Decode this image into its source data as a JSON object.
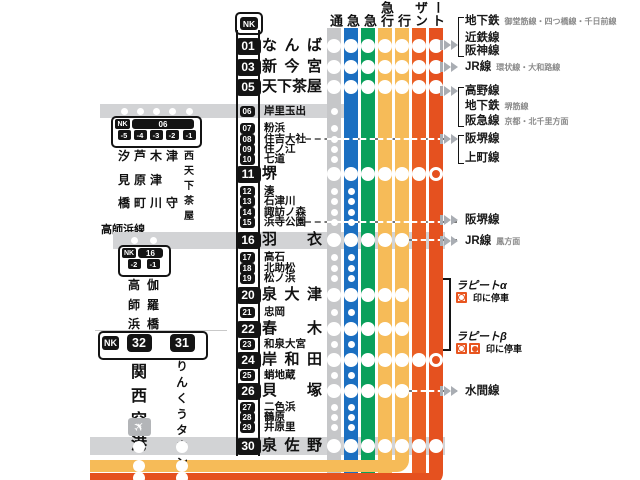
{
  "map": {
    "operator_prefix": "NK",
    "columns": [
      {
        "name": "local",
        "header": "通",
        "color": "#c6c7c9",
        "bottom": 480
      },
      {
        "name": "semi-express",
        "header": "急",
        "color": "#1b6fc1",
        "bottom": 480
      },
      {
        "name": "sub-express",
        "header": "急",
        "color": "#0aa05c",
        "bottom": 480
      },
      {
        "name": "express",
        "header": "急行",
        "color": "#f6bb58",
        "bottom": 480
      },
      {
        "name": "airport-express",
        "header": "行",
        "color": "#f6bb58",
        "bottom": 460
      },
      {
        "name": "southern",
        "header": "ザン",
        "color": "#ea5f24",
        "bottom": 480
      },
      {
        "name": "rapit",
        "header": "ート",
        "color": "#e5511f",
        "bottom": 473
      }
    ],
    "stations": [
      {
        "num": "01",
        "name": "なんば",
        "major": true,
        "y": 46,
        "marks": [
          "stop",
          "stop",
          "stop",
          "stop",
          "stop",
          "stop",
          "stop"
        ]
      },
      {
        "num": "03",
        "name": "新今宮",
        "major": true,
        "y": 67,
        "marks": [
          "stop",
          "stop",
          "stop",
          "stop",
          "stop",
          "stop",
          "stop"
        ]
      },
      {
        "num": "05",
        "name": "天下茶屋",
        "major": true,
        "y": 87,
        "marks": [
          "stop",
          "stop",
          "stop",
          "stop",
          "stop",
          "stop",
          "stop"
        ]
      },
      {
        "num": "06",
        "name": "岸里玉出",
        "major": false,
        "y": 111,
        "band": {
          "x1": 100,
          "x2": 345,
          "h": 14
        },
        "marks": [
          "dot",
          "",
          "",
          "",
          "",
          "",
          ""
        ]
      },
      {
        "num": "07",
        "name": "粉浜",
        "major": false,
        "y": 128,
        "marks": [
          "dot",
          "",
          "",
          "",
          "",
          "",
          ""
        ]
      },
      {
        "num": "08",
        "name": "住吉大社",
        "major": false,
        "y": 139,
        "dash": {
          "from": 305,
          "c1": 0,
          "c2": 6
        },
        "marks": [
          "dot",
          "",
          "",
          "",
          "",
          "",
          ""
        ]
      },
      {
        "num": "09",
        "name": "住ノ江",
        "major": false,
        "y": 149,
        "marks": [
          "dot",
          "",
          "",
          "",
          "",
          "",
          ""
        ]
      },
      {
        "num": "10",
        "name": "七道",
        "major": false,
        "y": 159,
        "marks": [
          "dot",
          "",
          "",
          "",
          "",
          "",
          ""
        ]
      },
      {
        "num": "11",
        "name": "堺",
        "major": true,
        "y": 174,
        "marks": [
          "stop",
          "stop",
          "stop",
          "stop",
          "stop",
          "stop",
          "ring"
        ]
      },
      {
        "num": "12",
        "name": "湊",
        "major": false,
        "y": 191,
        "marks": [
          "dot",
          "dot",
          "",
          "",
          "",
          "",
          ""
        ]
      },
      {
        "num": "13",
        "name": "石津川",
        "major": false,
        "y": 201,
        "marks": [
          "dot",
          "dot",
          "",
          "",
          "",
          "",
          ""
        ]
      },
      {
        "num": "14",
        "name": "諏訪ノ森",
        "major": false,
        "y": 212,
        "marks": [
          "dot",
          "dot",
          "",
          "",
          "",
          "",
          ""
        ]
      },
      {
        "num": "15",
        "name": "浜寺公園",
        "major": false,
        "y": 222,
        "dash": {
          "from": 305,
          "c1": 0,
          "c2": 6
        },
        "marks": [
          "dot",
          "dot",
          "",
          "",
          "",
          "",
          ""
        ]
      },
      {
        "num": "16",
        "name": "羽衣",
        "major": true,
        "y": 240,
        "band": {
          "x1": 113,
          "x2": 445,
          "h": 17
        },
        "dash": {
          "from": 408,
          "c1": 5,
          "c2": 6
        },
        "marks": [
          "stop",
          "stop",
          "stop",
          "stop",
          "stop",
          "",
          ""
        ]
      },
      {
        "num": "17",
        "name": "高石",
        "major": false,
        "y": 257,
        "marks": [
          "dot",
          "dot",
          "",
          "",
          "",
          "",
          ""
        ]
      },
      {
        "num": "18",
        "name": "北助松",
        "major": false,
        "y": 268,
        "marks": [
          "dot",
          "dot",
          "",
          "",
          "",
          "",
          ""
        ]
      },
      {
        "num": "19",
        "name": "松ノ浜",
        "major": false,
        "y": 278,
        "marks": [
          "dot",
          "dot",
          "",
          "",
          "",
          "",
          ""
        ]
      },
      {
        "num": "20",
        "name": "泉大津",
        "major": true,
        "y": 295,
        "marks": [
          "stop",
          "stop",
          "stop",
          "stop",
          "stop",
          "",
          ""
        ]
      },
      {
        "num": "21",
        "name": "忠岡",
        "major": false,
        "y": 312,
        "marks": [
          "dot",
          "dot",
          "",
          "",
          "",
          "",
          ""
        ]
      },
      {
        "num": "22",
        "name": "春木",
        "major": true,
        "y": 329,
        "marks": [
          "stop",
          "stop",
          "stop",
          "stop",
          "stop",
          "",
          ""
        ]
      },
      {
        "num": "23",
        "name": "和泉大宮",
        "major": false,
        "y": 344,
        "marks": [
          "dot",
          "dot",
          "",
          "",
          "",
          "",
          ""
        ]
      },
      {
        "num": "24",
        "name": "岸和田",
        "major": true,
        "y": 360,
        "marks": [
          "stop",
          "stop",
          "stop",
          "stop",
          "stop",
          "stop",
          "ring"
        ]
      },
      {
        "num": "25",
        "name": "蛸地蔵",
        "major": false,
        "y": 375,
        "marks": [
          "dot",
          "dot",
          "",
          "",
          "",
          "",
          ""
        ]
      },
      {
        "num": "26",
        "name": "貝塚",
        "major": true,
        "y": 391,
        "dash": {
          "from": 408,
          "c1": 5,
          "c2": 6
        },
        "marks": [
          "stop",
          "stop",
          "stop",
          "stop",
          "stop",
          "",
          ""
        ]
      },
      {
        "num": "27",
        "name": "二色浜",
        "major": false,
        "y": 407,
        "marks": [
          "dot",
          "dot",
          "",
          "",
          "",
          "",
          ""
        ]
      },
      {
        "num": "28",
        "name": "鶴原",
        "major": false,
        "y": 417,
        "marks": [
          "dot",
          "dot",
          "",
          "",
          "",
          "",
          ""
        ]
      },
      {
        "num": "29",
        "name": "井原里",
        "major": false,
        "y": 427,
        "marks": [
          "dot",
          "dot",
          "",
          "",
          "",
          "",
          ""
        ]
      },
      {
        "num": "30",
        "name": "泉佐野",
        "major": true,
        "y": 446,
        "band": {
          "x1": 90,
          "x2": 445,
          "h": 18
        },
        "marks": [
          "stop",
          "stop",
          "stop",
          "stop",
          "stop",
          "stop",
          "stop"
        ]
      }
    ]
  },
  "branches": {
    "shiomibashi": {
      "badge_number": "06",
      "sub_numbers": [
        "-5",
        "-4",
        "-3",
        "-2",
        "-1"
      ],
      "stations": [
        "汐見橋",
        "芦原町",
        "木津川",
        "津守",
        "西天下茶屋"
      ]
    },
    "takashinohama": {
      "line_label": "高師浜線",
      "badge_number": "16",
      "sub_numbers": [
        "-2",
        "-1"
      ],
      "stations": [
        "高師浜",
        "伽羅橋"
      ]
    },
    "airport": {
      "badge_numbers": [
        "32",
        "31"
      ],
      "stations": [
        "関西空港",
        "りんくうタウン"
      ]
    }
  },
  "legend": {
    "groups": [
      {
        "chevron_y": 45,
        "bracket": [
          21,
          51
        ],
        "items": [
          {
            "label": "地下鉄",
            "sub": "御堂筋線・四つ橋線・千日前線",
            "y": 21
          },
          {
            "label": "近鉄線",
            "sub": "",
            "y": 38
          },
          {
            "label": "阪神線",
            "sub": "",
            "y": 51
          }
        ]
      },
      {
        "chevron_y": 67,
        "items": [
          {
            "label": "JR線",
            "sub": "環状線・大和路線",
            "y": 67
          }
        ]
      },
      {
        "chevron_y": 91,
        "bracket": [
          91,
          121
        ],
        "items": [
          {
            "label": "高野線",
            "sub": "",
            "y": 91
          },
          {
            "label": "地下鉄",
            "sub": "堺筋線",
            "y": 106
          },
          {
            "label": "阪急線",
            "sub": "京都・北千里方面",
            "y": 121
          }
        ]
      },
      {
        "chevron_y": 139,
        "bracket": [
          139,
          158
        ],
        "items": [
          {
            "label": "阪堺線",
            "sub": "",
            "y": 139
          },
          {
            "label": "上町線",
            "sub": "",
            "y": 158
          }
        ]
      },
      {
        "chevron_y": 220,
        "items": [
          {
            "label": "阪堺線",
            "sub": "",
            "y": 220
          }
        ]
      },
      {
        "chevron_y": 241,
        "items": [
          {
            "label": "JR線",
            "sub": "鳳方面",
            "y": 241
          }
        ]
      },
      {
        "chevron_y": 391,
        "items": [
          {
            "label": "水間線",
            "sub": "",
            "y": 391
          }
        ]
      }
    ],
    "rapit": {
      "alpha_label": "ラピートα",
      "beta_label": "ラピートβ",
      "alpha_note": "印に停車",
      "beta_note": "印に停車"
    }
  }
}
